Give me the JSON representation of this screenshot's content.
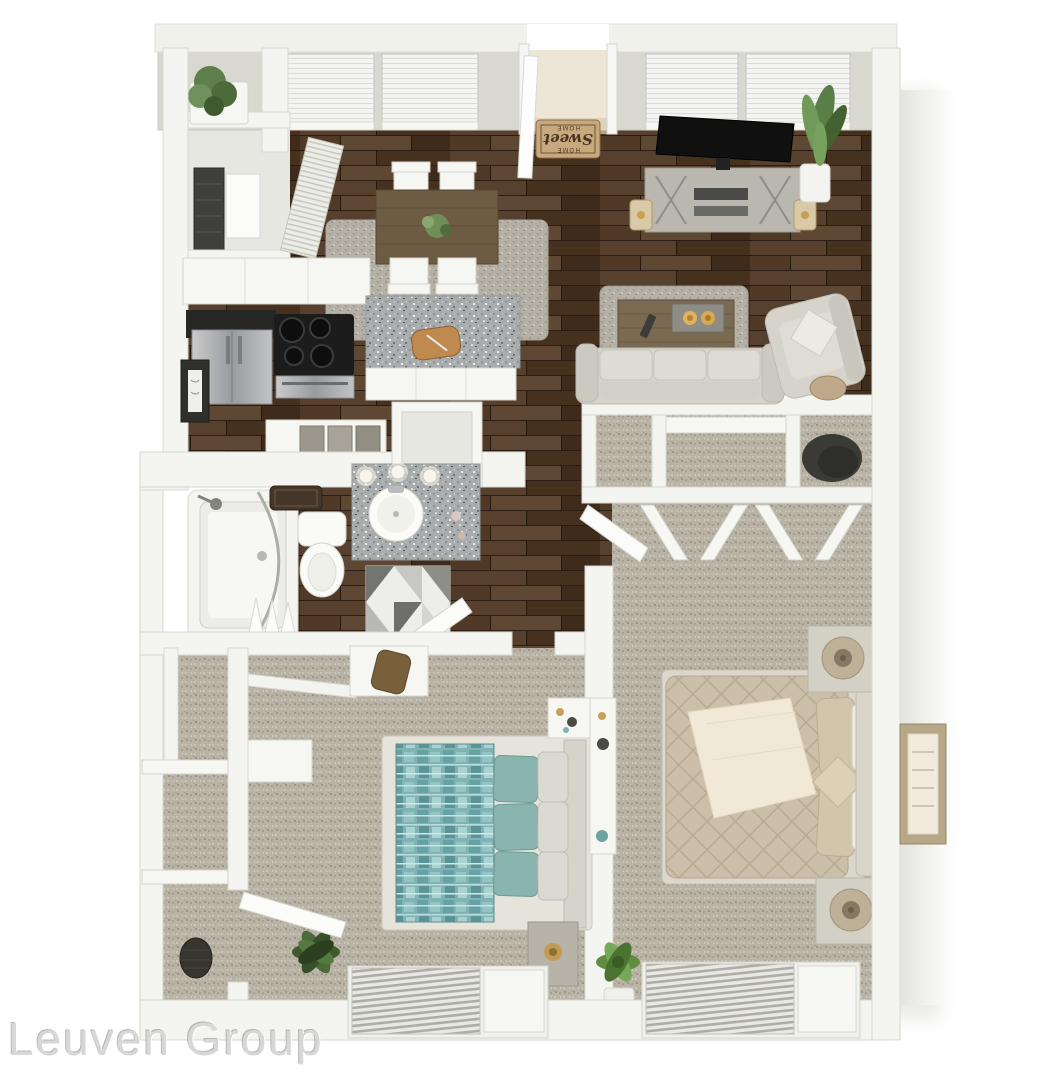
{
  "watermark": {
    "text": "Leuven Group"
  },
  "entry_doormat": {
    "top": "HOME",
    "middle": "Sweet",
    "bottom": "HOME"
  },
  "palette": {
    "background": "#FFFFFF",
    "walls": "#F4F4F0",
    "wall_face": "#D8D8D0",
    "wood_floor": "#4E3A29",
    "carpet": "#B9B3A6",
    "granite": "#A8ACAC",
    "teal_bedding": "#7FB3B5",
    "champagne_bedding": "#CBBFA9",
    "doormat_tan": "#C8A97E",
    "plant_green": "#5E7F4B",
    "appliance_steel": "#9EA1A4",
    "stove_black": "#1C1C1C"
  },
  "rooms": [
    {
      "id": "entry",
      "furniture": [
        "entry-door",
        "welcome-mat",
        "plant-shelf"
      ]
    },
    {
      "id": "laundry-closet",
      "furniture": [
        "water-heater",
        "louvered-door",
        "closet-door"
      ]
    },
    {
      "id": "kitchen",
      "furniture": [
        "refrigerator",
        "stove",
        "black-counter",
        "granite-peninsula",
        "cutting-board",
        "wall-art"
      ]
    },
    {
      "id": "dining-area",
      "furniture": [
        "dining-table",
        "four-chairs",
        "centerpiece",
        "area-rug"
      ]
    },
    {
      "id": "living-room",
      "furniture": [
        "tv",
        "media-console",
        "lanterns",
        "floor-plant",
        "coffee-table",
        "candle-tray",
        "remote",
        "sofa",
        "armchair",
        "throw-pillow",
        "shag-rug"
      ]
    },
    {
      "id": "bathroom",
      "furniture": [
        "bathtub",
        "shower-rod",
        "shower-curtain",
        "shower-head",
        "bath-mat",
        "toilet",
        "granite-vanity",
        "vessel-sink",
        "vanity-lights",
        "geometric-rug",
        "open-door"
      ]
    },
    {
      "id": "hallway",
      "furniture": [
        "folded-towels",
        "storage-nook",
        "closet-alcoves",
        "accent-chair"
      ]
    },
    {
      "id": "bedroom",
      "furniture": [
        "teal-bed",
        "accent-pillows",
        "nightstand",
        "desk",
        "closet-shelf",
        "cabinet",
        "duffel-bag",
        "pedestal-table",
        "plant",
        "window-blinds",
        "open-door"
      ]
    },
    {
      "id": "master-bedroom",
      "furniture": [
        "upholstered-bed",
        "cream-throw",
        "diamond-pillow",
        "nightstand-pair",
        "lamps",
        "bifold-closet-doors",
        "console-table",
        "wall-art",
        "plant",
        "window-blinds",
        "open-door"
      ]
    },
    {
      "id": "hall-closets",
      "furniture": [
        "shelves",
        "basket"
      ]
    }
  ],
  "windows": {
    "top_wall": 4,
    "bottom_wall": 2,
    "entry_doors": 1
  }
}
